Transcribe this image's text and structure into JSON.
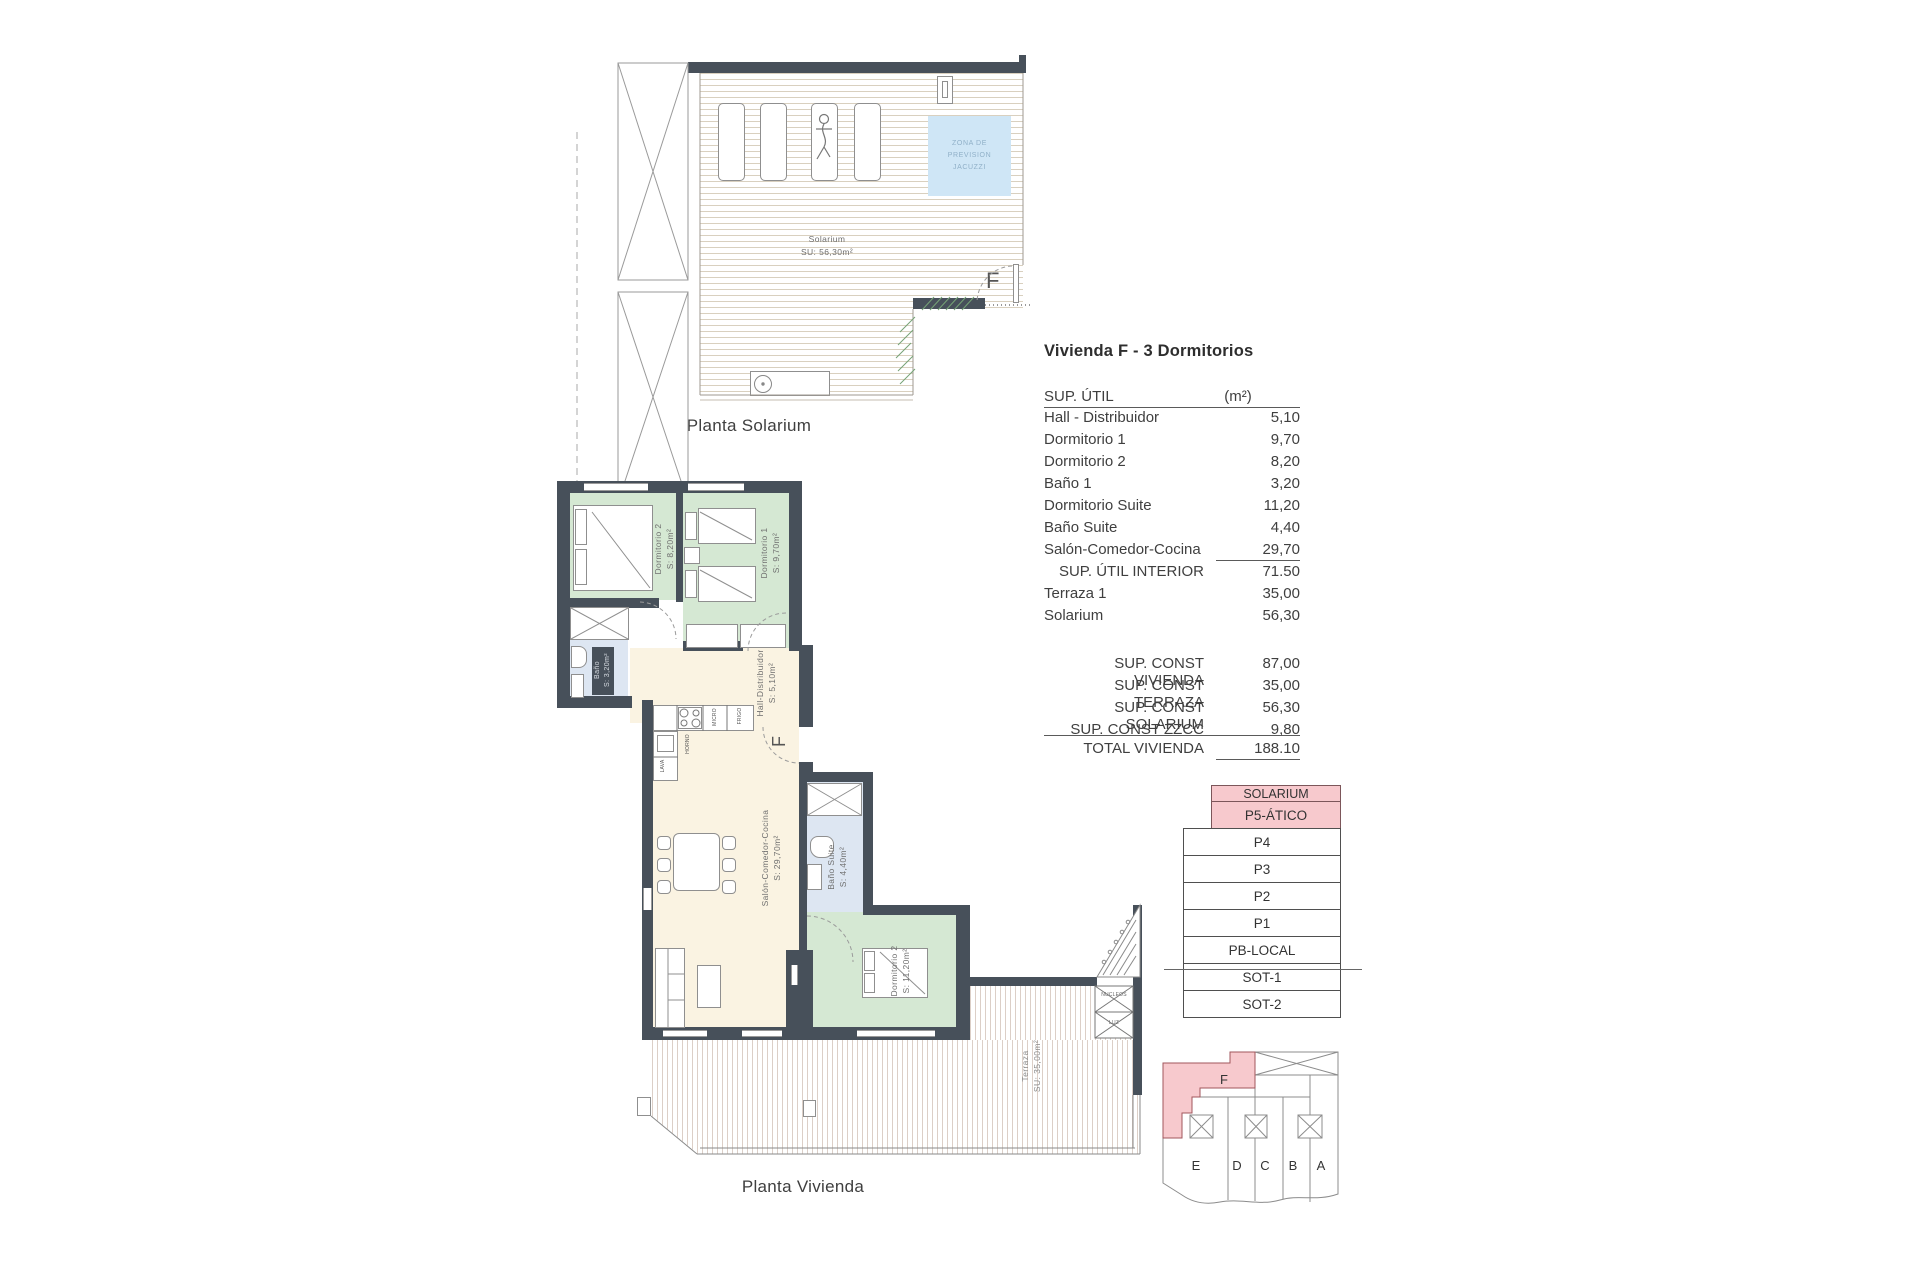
{
  "colors": {
    "wall": "#47505a",
    "room_green": "#d5e8d3",
    "room_cream": "#faf3e2",
    "room_blue": "#dde6f2",
    "jacuzzi_fill": "#cfe6f6",
    "jacuzzi_text": "#90b0c8",
    "pink_fill": "#f7c9cd",
    "pink_border": "#a2565c",
    "hatch_green": "#76a376",
    "deck_line": "#d9d0bf"
  },
  "solarium_plan": {
    "caption": "Planta Solarium",
    "room_label": "Solarium",
    "room_area": "SU: 56,30m²",
    "jacuzzi_line1": "ZONA DE",
    "jacuzzi_line2": "PREVISION",
    "jacuzzi_line3": "JACUZZI",
    "door_label": "F"
  },
  "vivienda_plan": {
    "caption": "Planta Vivienda",
    "door_label": "F",
    "rooms": {
      "dormitorio2": {
        "name": "Dormitorio 2",
        "area": "S: 8,20m²"
      },
      "dormitorio1": {
        "name": "Dormitorio 1",
        "area": "S: 9,70m²"
      },
      "bano": {
        "name": "Baño",
        "area": "S: 3,20m²"
      },
      "hall": {
        "name": "Hall-Distribuidor",
        "area": "S: 5,10m²"
      },
      "salon": {
        "name": "Salón-Comedor-Cocina",
        "area": "S: 29,70m²"
      },
      "bano_suite": {
        "name": "Baño Suite",
        "area": "S: 4,40m²"
      },
      "dormitorio_suite": {
        "name": "Dormitorio 2",
        "area": "S: 11,20m²"
      },
      "terraza": {
        "name": "Terraza",
        "area": "SU: 35,00m²"
      }
    },
    "kitchen": {
      "micro": "MICRO",
      "frigo": "FRIGO",
      "horno": "HORNO",
      "lava": "LAVA"
    },
    "core": {
      "top": "NUCLEOS",
      "bottom": "LUZ"
    }
  },
  "area_table": {
    "title": "Vivienda F - 3 Dormitorios",
    "header": {
      "label": "SUP. ÚTIL",
      "unit": "(m²)"
    },
    "rows": [
      {
        "label": "Hall - Distribuidor",
        "value": "5,10"
      },
      {
        "label": "Dormitorio 1",
        "value": "9,70"
      },
      {
        "label": "Dormitorio 2",
        "value": "8,20"
      },
      {
        "label": "Baño 1",
        "value": "3,20"
      },
      {
        "label": "Dormitorio Suite",
        "value": "11,20"
      },
      {
        "label": "Baño Suite",
        "value": "4,40"
      },
      {
        "label": "Salón-Comedor-Cocina",
        "value": "29,70"
      },
      {
        "label": "SUP. ÚTIL INTERIOR",
        "value": "71.50"
      },
      {
        "label": "Terraza 1",
        "value": "35,00"
      },
      {
        "label": "Solarium",
        "value": "56,30"
      }
    ],
    "totals": [
      {
        "label": "SUP. CONST VIVIENDA",
        "value": "87,00"
      },
      {
        "label": "SUP. CONST TERRAZA",
        "value": "35,00"
      },
      {
        "label": "SUP. CONST SOLARIUM",
        "value": "56,30"
      },
      {
        "label": "SUP. CONST ZZCC",
        "value": "9,80"
      },
      {
        "label": "TOTAL VIVIENDA",
        "value": "188.10"
      }
    ]
  },
  "floor_stack": {
    "rows": [
      {
        "label": "SOLARIUM"
      },
      {
        "label": "P5-ÁTICO"
      },
      {
        "label": "P4"
      },
      {
        "label": "P3"
      },
      {
        "label": "P2"
      },
      {
        "label": "P1"
      },
      {
        "label": "PB-LOCAL"
      },
      {
        "label": "SOT-1"
      },
      {
        "label": "SOT-2"
      }
    ]
  },
  "key_plan": {
    "highlight_label": "F",
    "units": [
      "E",
      "D",
      "C",
      "B",
      "A"
    ]
  }
}
